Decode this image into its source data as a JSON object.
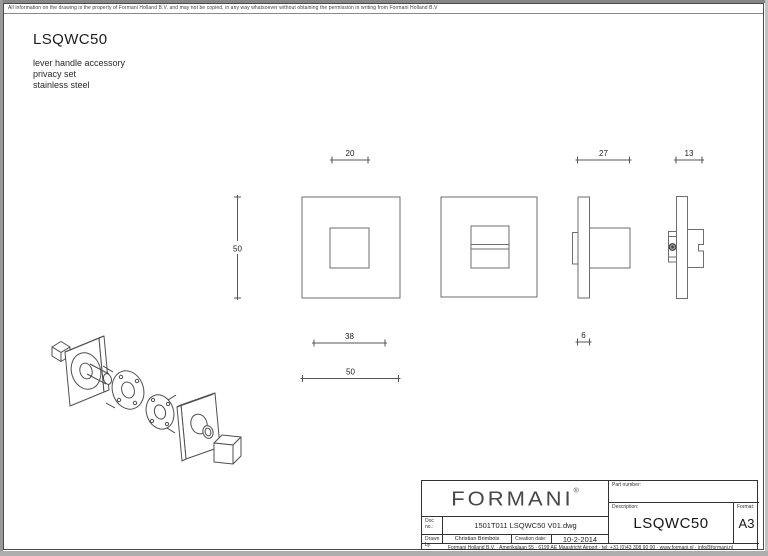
{
  "sheet": {
    "disclaimer": "All information on the drawing is the property of Formani Holland B.V. and may not be copied, in any way whatsoever without obtaining the permission in writing from Formani Holland B.V",
    "title": "LSQWC50",
    "subtitle_line1": "lever handle accessory",
    "subtitle_line2": "privacy set",
    "subtitle_line3": "stainless steel"
  },
  "drawing": {
    "dims": {
      "turn_width_top": "20",
      "rose_height": "50",
      "depth_total": "27",
      "depth_release": "13",
      "inner_width": "38",
      "rose_width": "50",
      "plate_thickness": "6"
    }
  },
  "title_block": {
    "logo_text": "FORMANI",
    "logo_reg": "®",
    "doc_no_label": "Doc no.:",
    "doc_no_value": "1501T011 LSQWC50 V01.dwg",
    "drawn_by_label": "Drawn by:",
    "drawn_by_value": "Christian Brimbois",
    "creation_date_label": "Creation date:",
    "creation_date_value": "10-2-2014",
    "part_number_label": "Part number:",
    "description_label": "Description:",
    "description_value": "LSQWC50",
    "format_label": "Format:",
    "format_value": "A3",
    "footer": "Formani Holland B.V.  ·  Amerikalaan 55  ·  6199 AE Maastricht Airport  ·  tel: +31 (0)43 308 90 00  ·  www.formani.nl  ·  info@formani.nl"
  },
  "colors": {
    "line_geometry": "#6e6e6e",
    "line_dimension": "#555555",
    "text": "#1c1c1c",
    "border": "#4a4a4a"
  }
}
